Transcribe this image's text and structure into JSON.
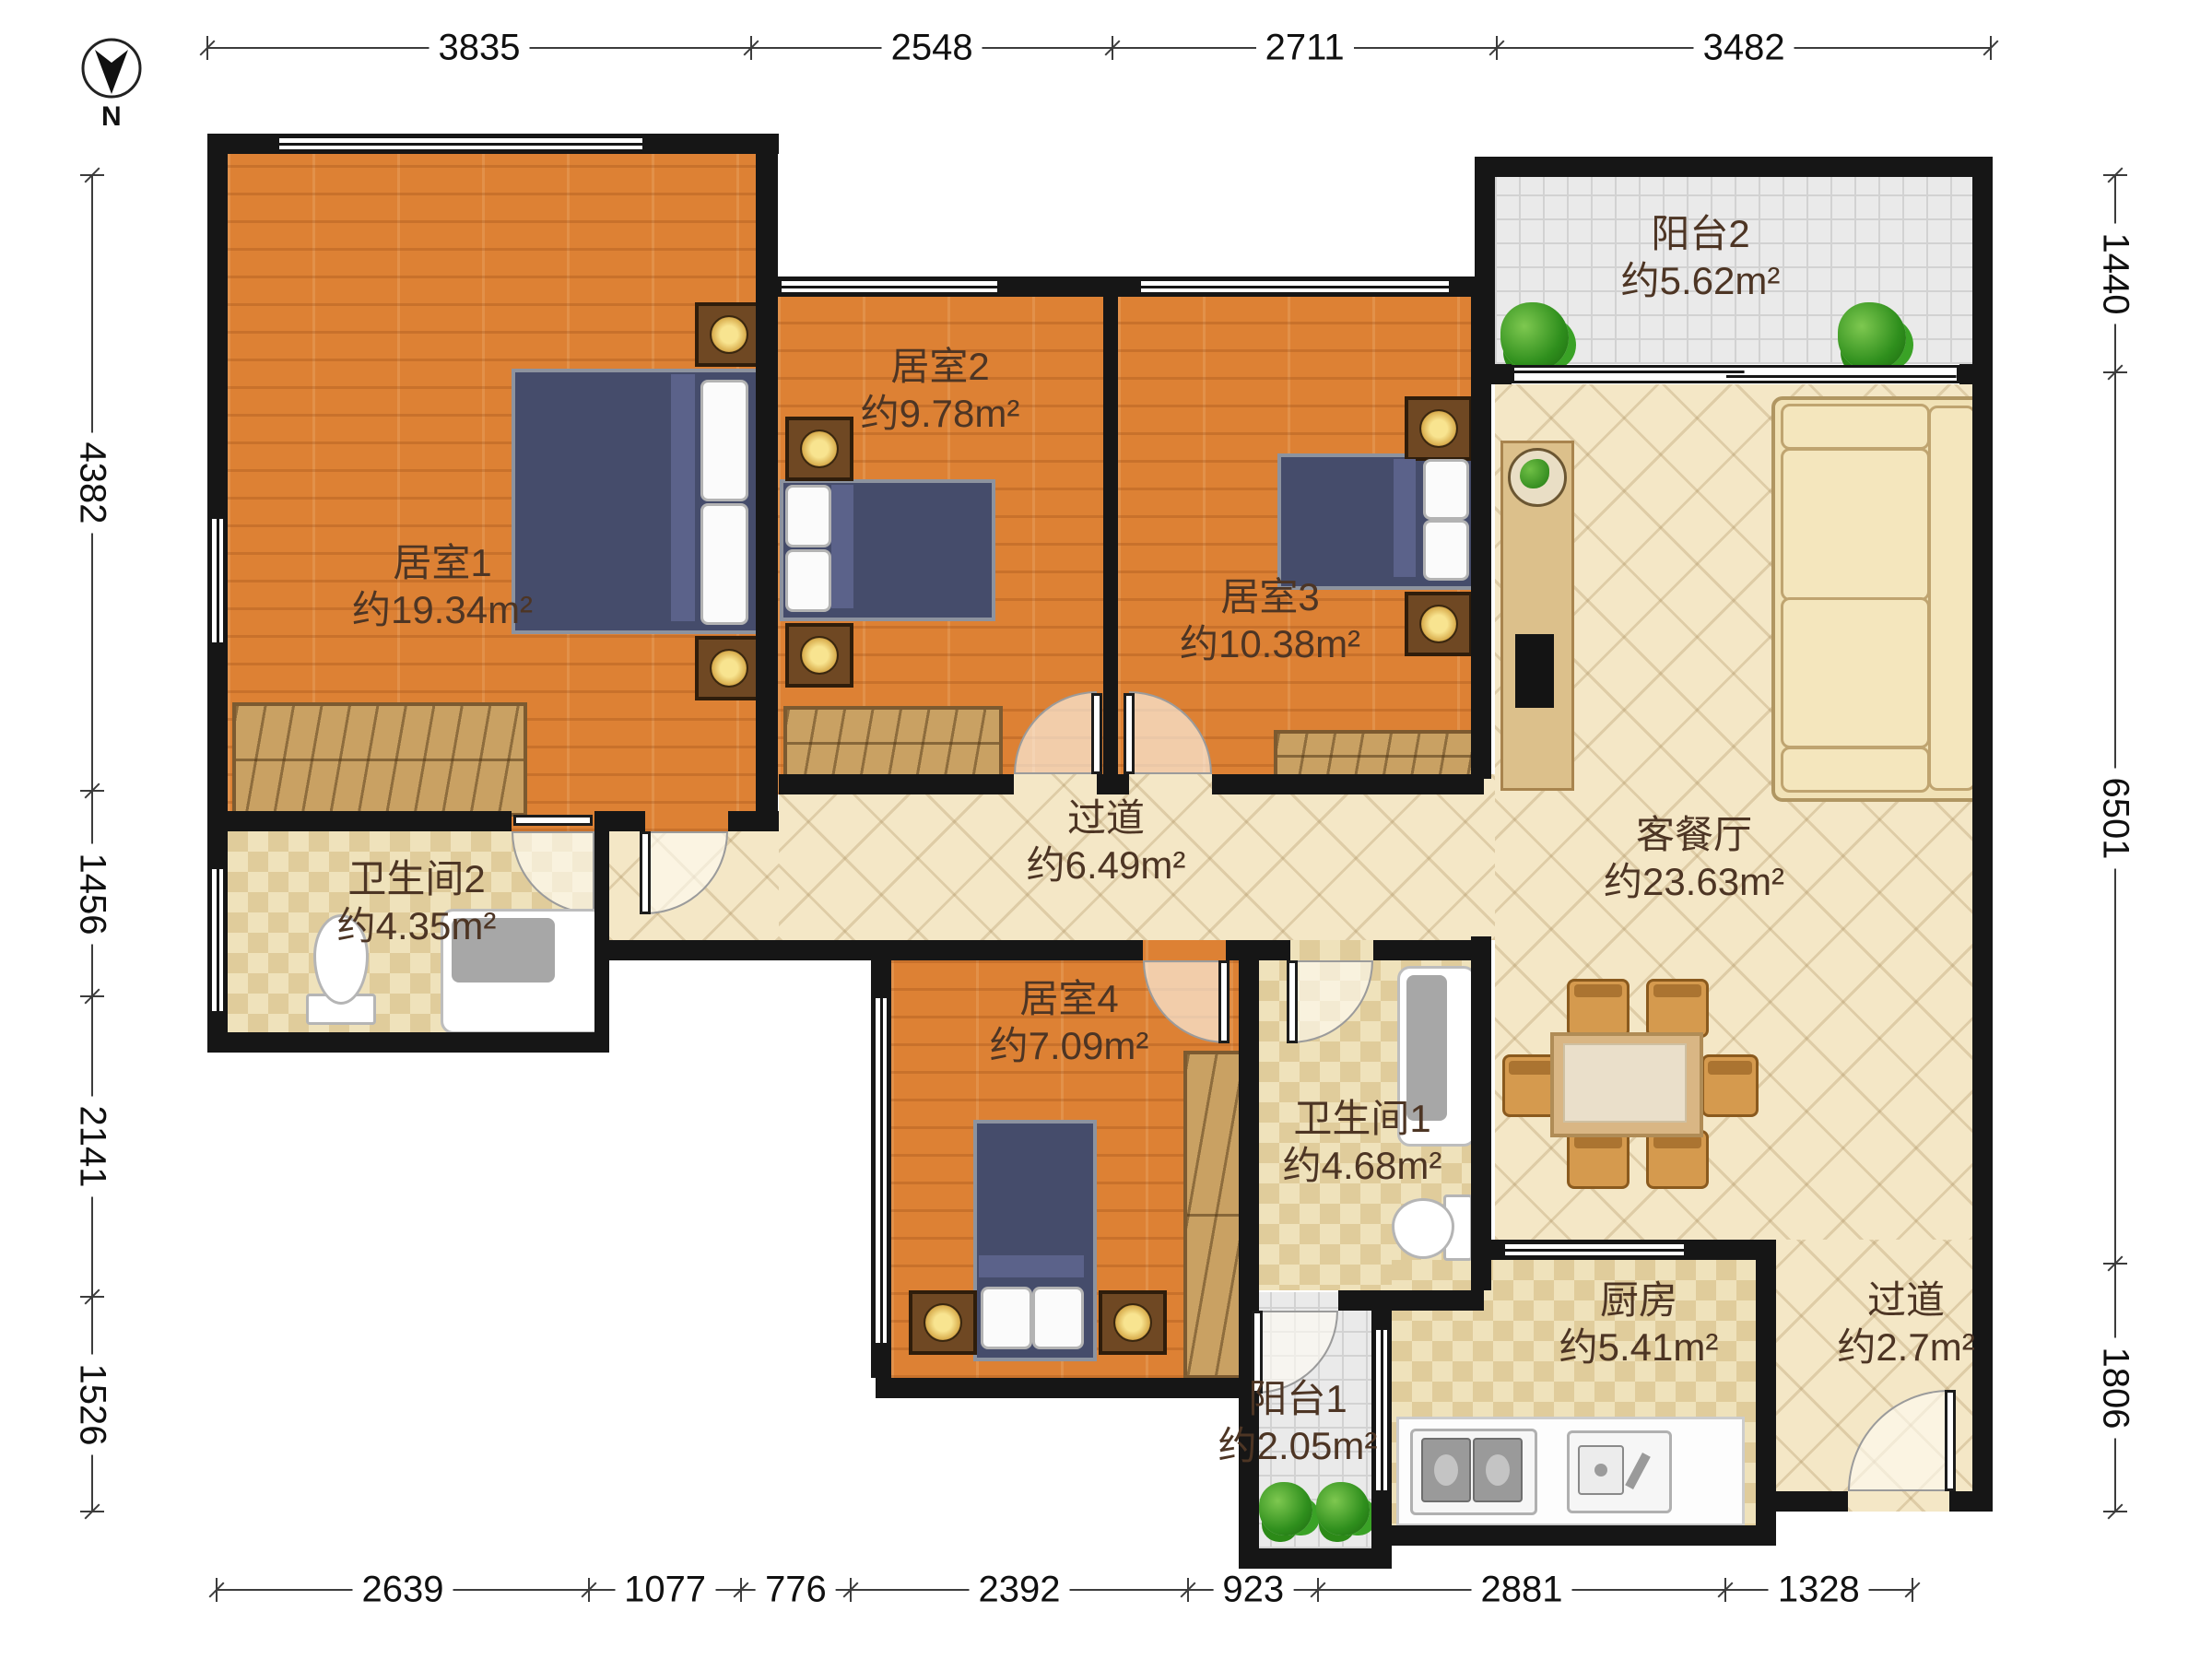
{
  "compass": {
    "label": "N"
  },
  "dimensions": {
    "top": [
      "3835",
      "2548",
      "2711",
      "3482"
    ],
    "left": [
      "4382",
      "1456",
      "2141",
      "1526"
    ],
    "right": [
      "1440",
      "6501",
      "1806"
    ],
    "bottom": [
      "2639",
      "1077",
      "776",
      "2392",
      "923",
      "2881",
      "1328"
    ]
  },
  "rooms": [
    {
      "id": "bedroom1",
      "name": "居室1",
      "area": "约19.34m²"
    },
    {
      "id": "bedroom2",
      "name": "居室2",
      "area": "约9.78m²"
    },
    {
      "id": "bedroom3",
      "name": "居室3",
      "area": "约10.38m²"
    },
    {
      "id": "bedroom4",
      "name": "居室4",
      "area": "约7.09m²"
    },
    {
      "id": "bathroom2",
      "name": "卫生间2",
      "area": "约4.35m²"
    },
    {
      "id": "bathroom1",
      "name": "卫生间1",
      "area": "约4.68m²"
    },
    {
      "id": "hallway",
      "name": "过道",
      "area": "约6.49m²"
    },
    {
      "id": "living",
      "name": "客餐厅",
      "area": "约23.63m²"
    },
    {
      "id": "kitchen",
      "name": "厨房",
      "area": "约5.41m²"
    },
    {
      "id": "corridor",
      "name": "过道",
      "area": "约2.7m²"
    },
    {
      "id": "balcony2",
      "name": "阳台2",
      "area": "约5.62m²"
    },
    {
      "id": "balcony1",
      "name": "阳台1",
      "area": "约2.05m²"
    }
  ],
  "colors": {
    "wall": "#161616",
    "wood_floor": "#dd8134",
    "tile_floor": "#f4e7c6",
    "checker_floor": "#efe2bb",
    "balcony_floor": "#eaeaea",
    "label_text": "#4d3524",
    "bed_duvet": "#454c6b",
    "wardrobe": "#c9a163",
    "sofa": "#f1e2b6",
    "plant": "#2f8f1d"
  }
}
